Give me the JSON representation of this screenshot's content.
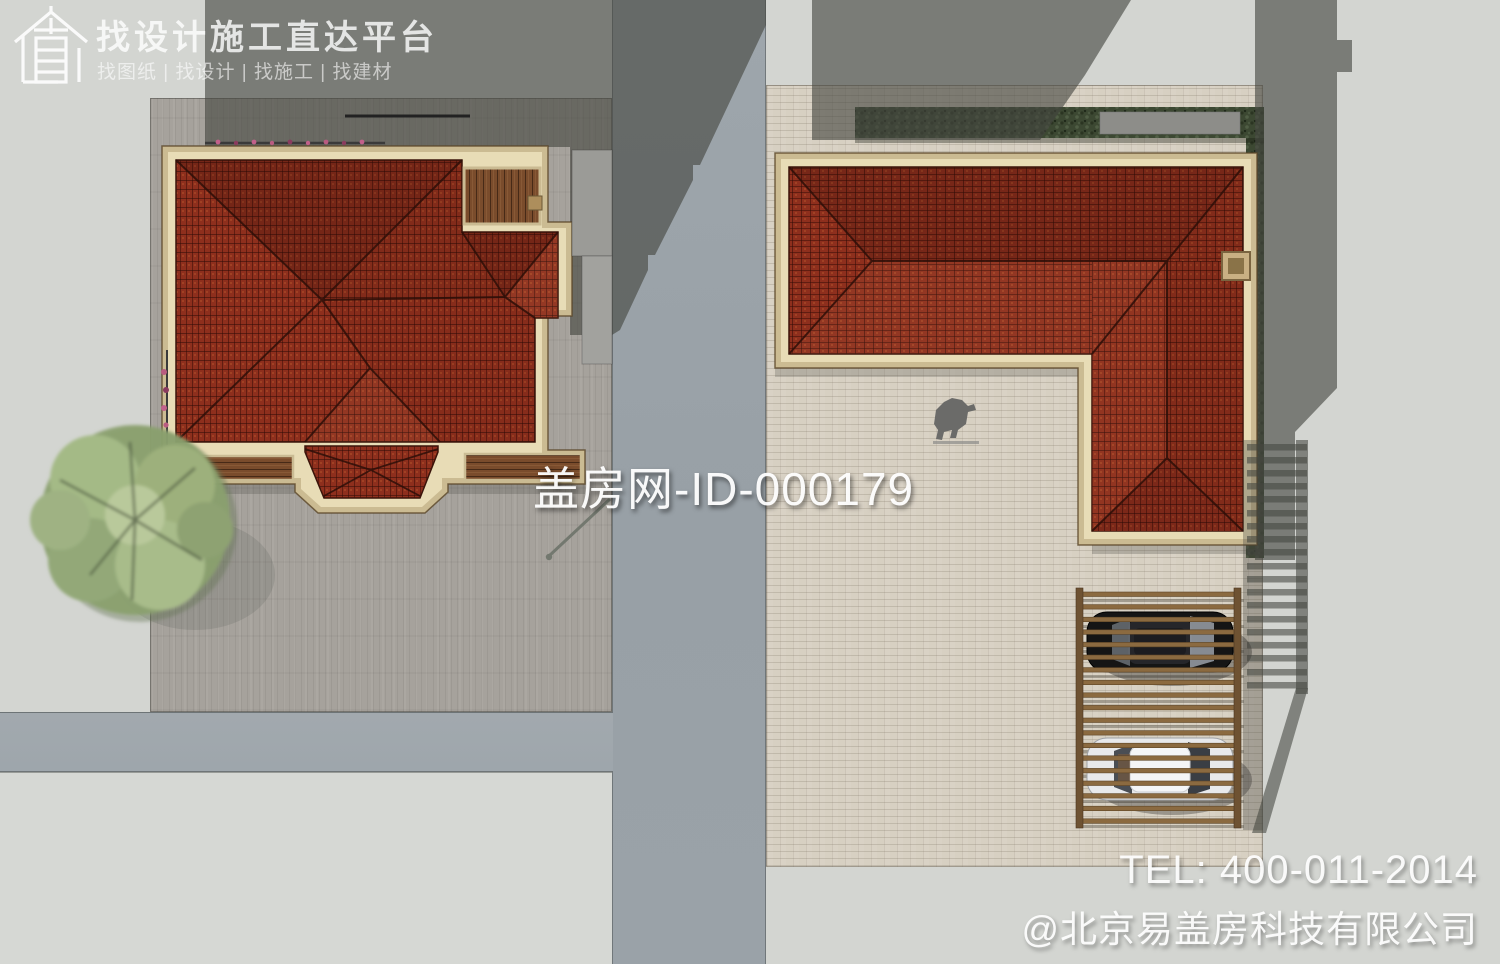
{
  "header": {
    "logo_icon": "house-logo-icon",
    "logo_glyph": "直",
    "title": "找设计施工直达平台",
    "subtitle": "找图纸 | 找设计 | 找施工 | 找建材"
  },
  "watermark": {
    "text": "盖房网-ID-000179"
  },
  "footer": {
    "tel": "TEL: 400-011-2014",
    "company": "@北京易盖房科技有限公司"
  },
  "colors": {
    "background": "#d3d5d1",
    "shadow": "#44463f",
    "road": "#9ea6ac",
    "left_plot_paving": "#a6a29c",
    "right_plot_paving": "#d7d0c2",
    "roof_red": "#8e2f1d",
    "roof_line": "#2e0f08",
    "trim_outer": "#cbbb92",
    "trim_inner": "#e8dcb6",
    "wood_deck": "#7a4c2c",
    "pergola_wood": "#8b6a40",
    "hedge_green": "#3c4832",
    "tree_green": "#8aa06f",
    "car_black": "#151515",
    "car_white": "#e8e9eb"
  }
}
